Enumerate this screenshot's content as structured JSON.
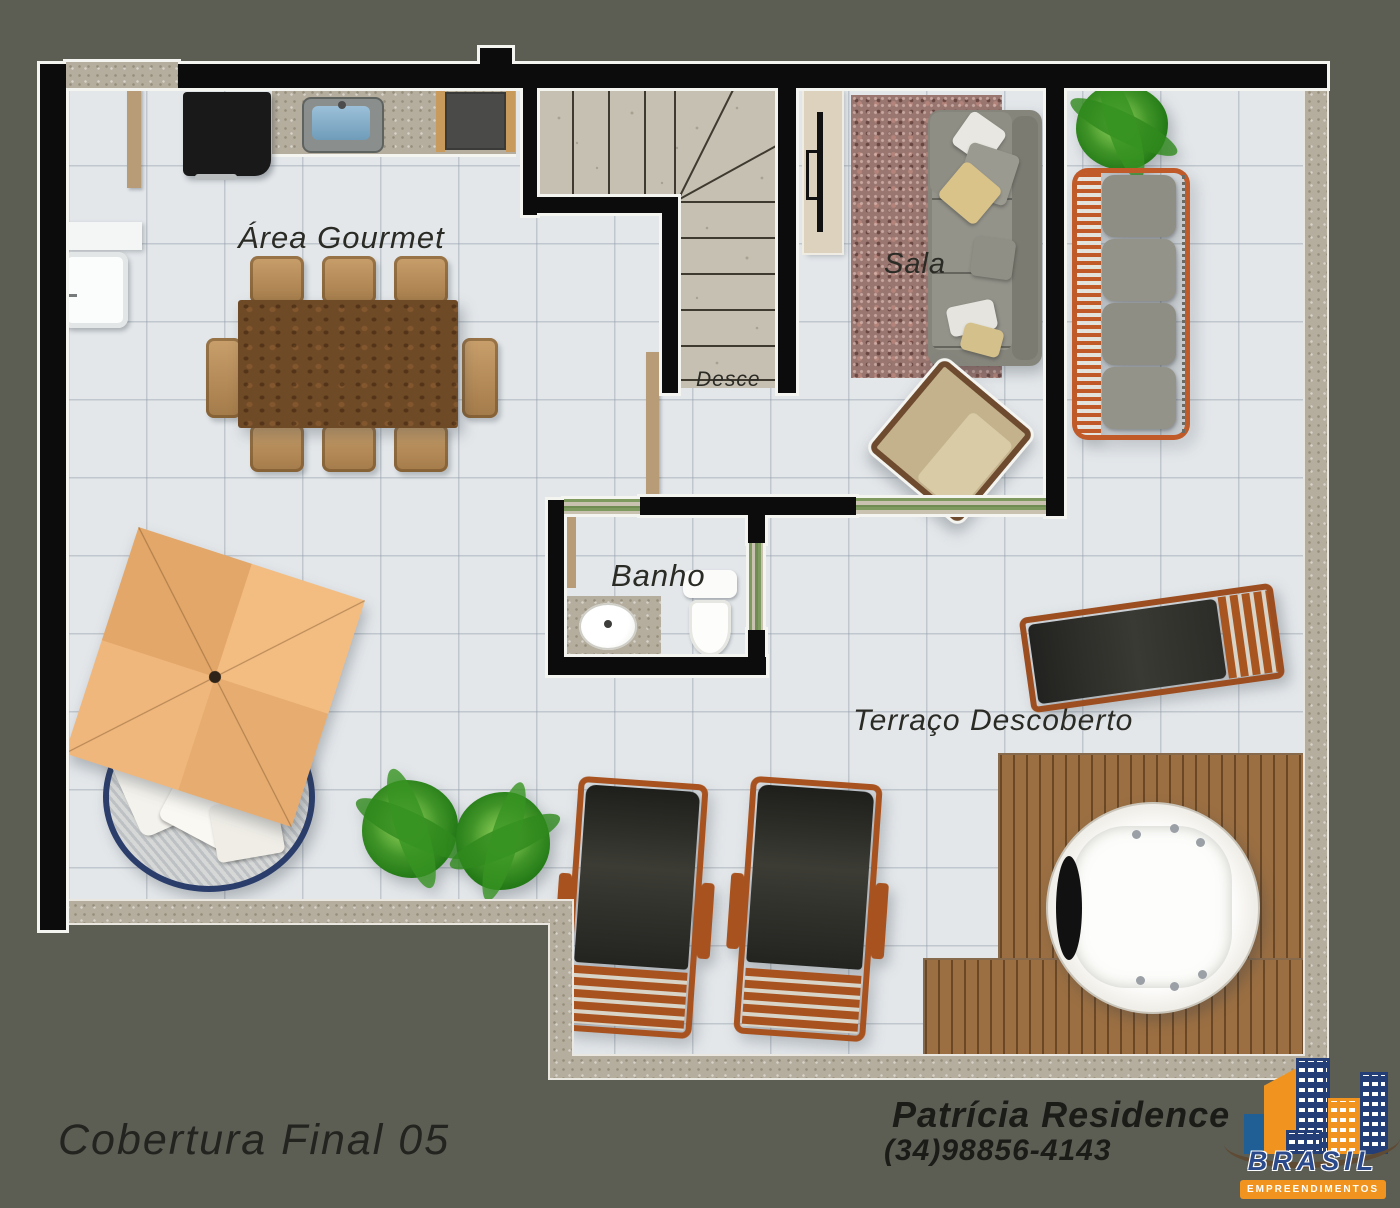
{
  "labels": {
    "area_gourmet": "Área Gourmet",
    "sala": "Sala",
    "desce": "Desce",
    "banho": "Banho",
    "terraco": "Terraço Descoberto"
  },
  "footer": {
    "title": "Cobertura Final 05",
    "contact_name": "Patrícia Residence",
    "contact_phone": "(34)98856-4143"
  },
  "logo": {
    "brand": "BRASIL",
    "tagline": "EMPREENDIMENTOS"
  },
  "colors": {
    "background": "#5c5e54",
    "floor_tile": "#e3e7ea",
    "wall": "#0c0c0c",
    "wall_outline": "#f4f4f0",
    "stone": "#b5ae9e",
    "wood_deck": "#9b6f42",
    "furniture_orange": "#a8531f",
    "umbrella_orange": "#f0b77c",
    "daybed_rim_navy": "#2b3e6b",
    "table_wood": "#6f4a26",
    "chair_tan": "#b89b77",
    "sofa_gray": "#85857c",
    "rug_maroon": "#9a7670",
    "logo_orange": "#f0941f",
    "logo_navy": "#243f77"
  }
}
